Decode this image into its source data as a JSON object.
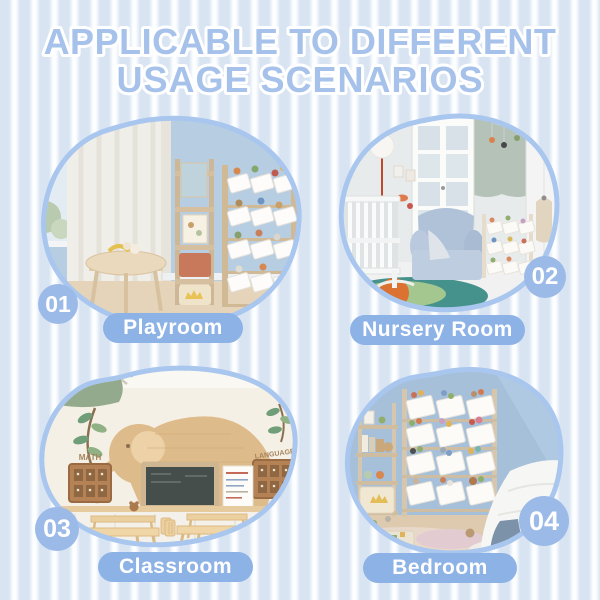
{
  "title": {
    "line1": "APPLICABLE TO DIFFERENT",
    "line2": "USAGE SCENARIOS"
  },
  "scenarios": [
    {
      "number": "01",
      "label": "Playroom"
    },
    {
      "number": "02",
      "label": "Nursery Room"
    },
    {
      "number": "03",
      "label": "Classroom",
      "wall_labels": [
        "MATH",
        "LANGUAGE"
      ]
    },
    {
      "number": "04",
      "label": "Bedroom"
    }
  ],
  "colors": {
    "stripe_blue": "#d9e4f3",
    "stripe_white": "#fdfeff",
    "title_blue": "#a6c2ea",
    "title_outline": "#ffffff",
    "blob_border": "#a9c6ee",
    "badge_blue": "#9cbae7",
    "pill_blue": "#8db2e6",
    "label_text": "#ffffff"
  }
}
